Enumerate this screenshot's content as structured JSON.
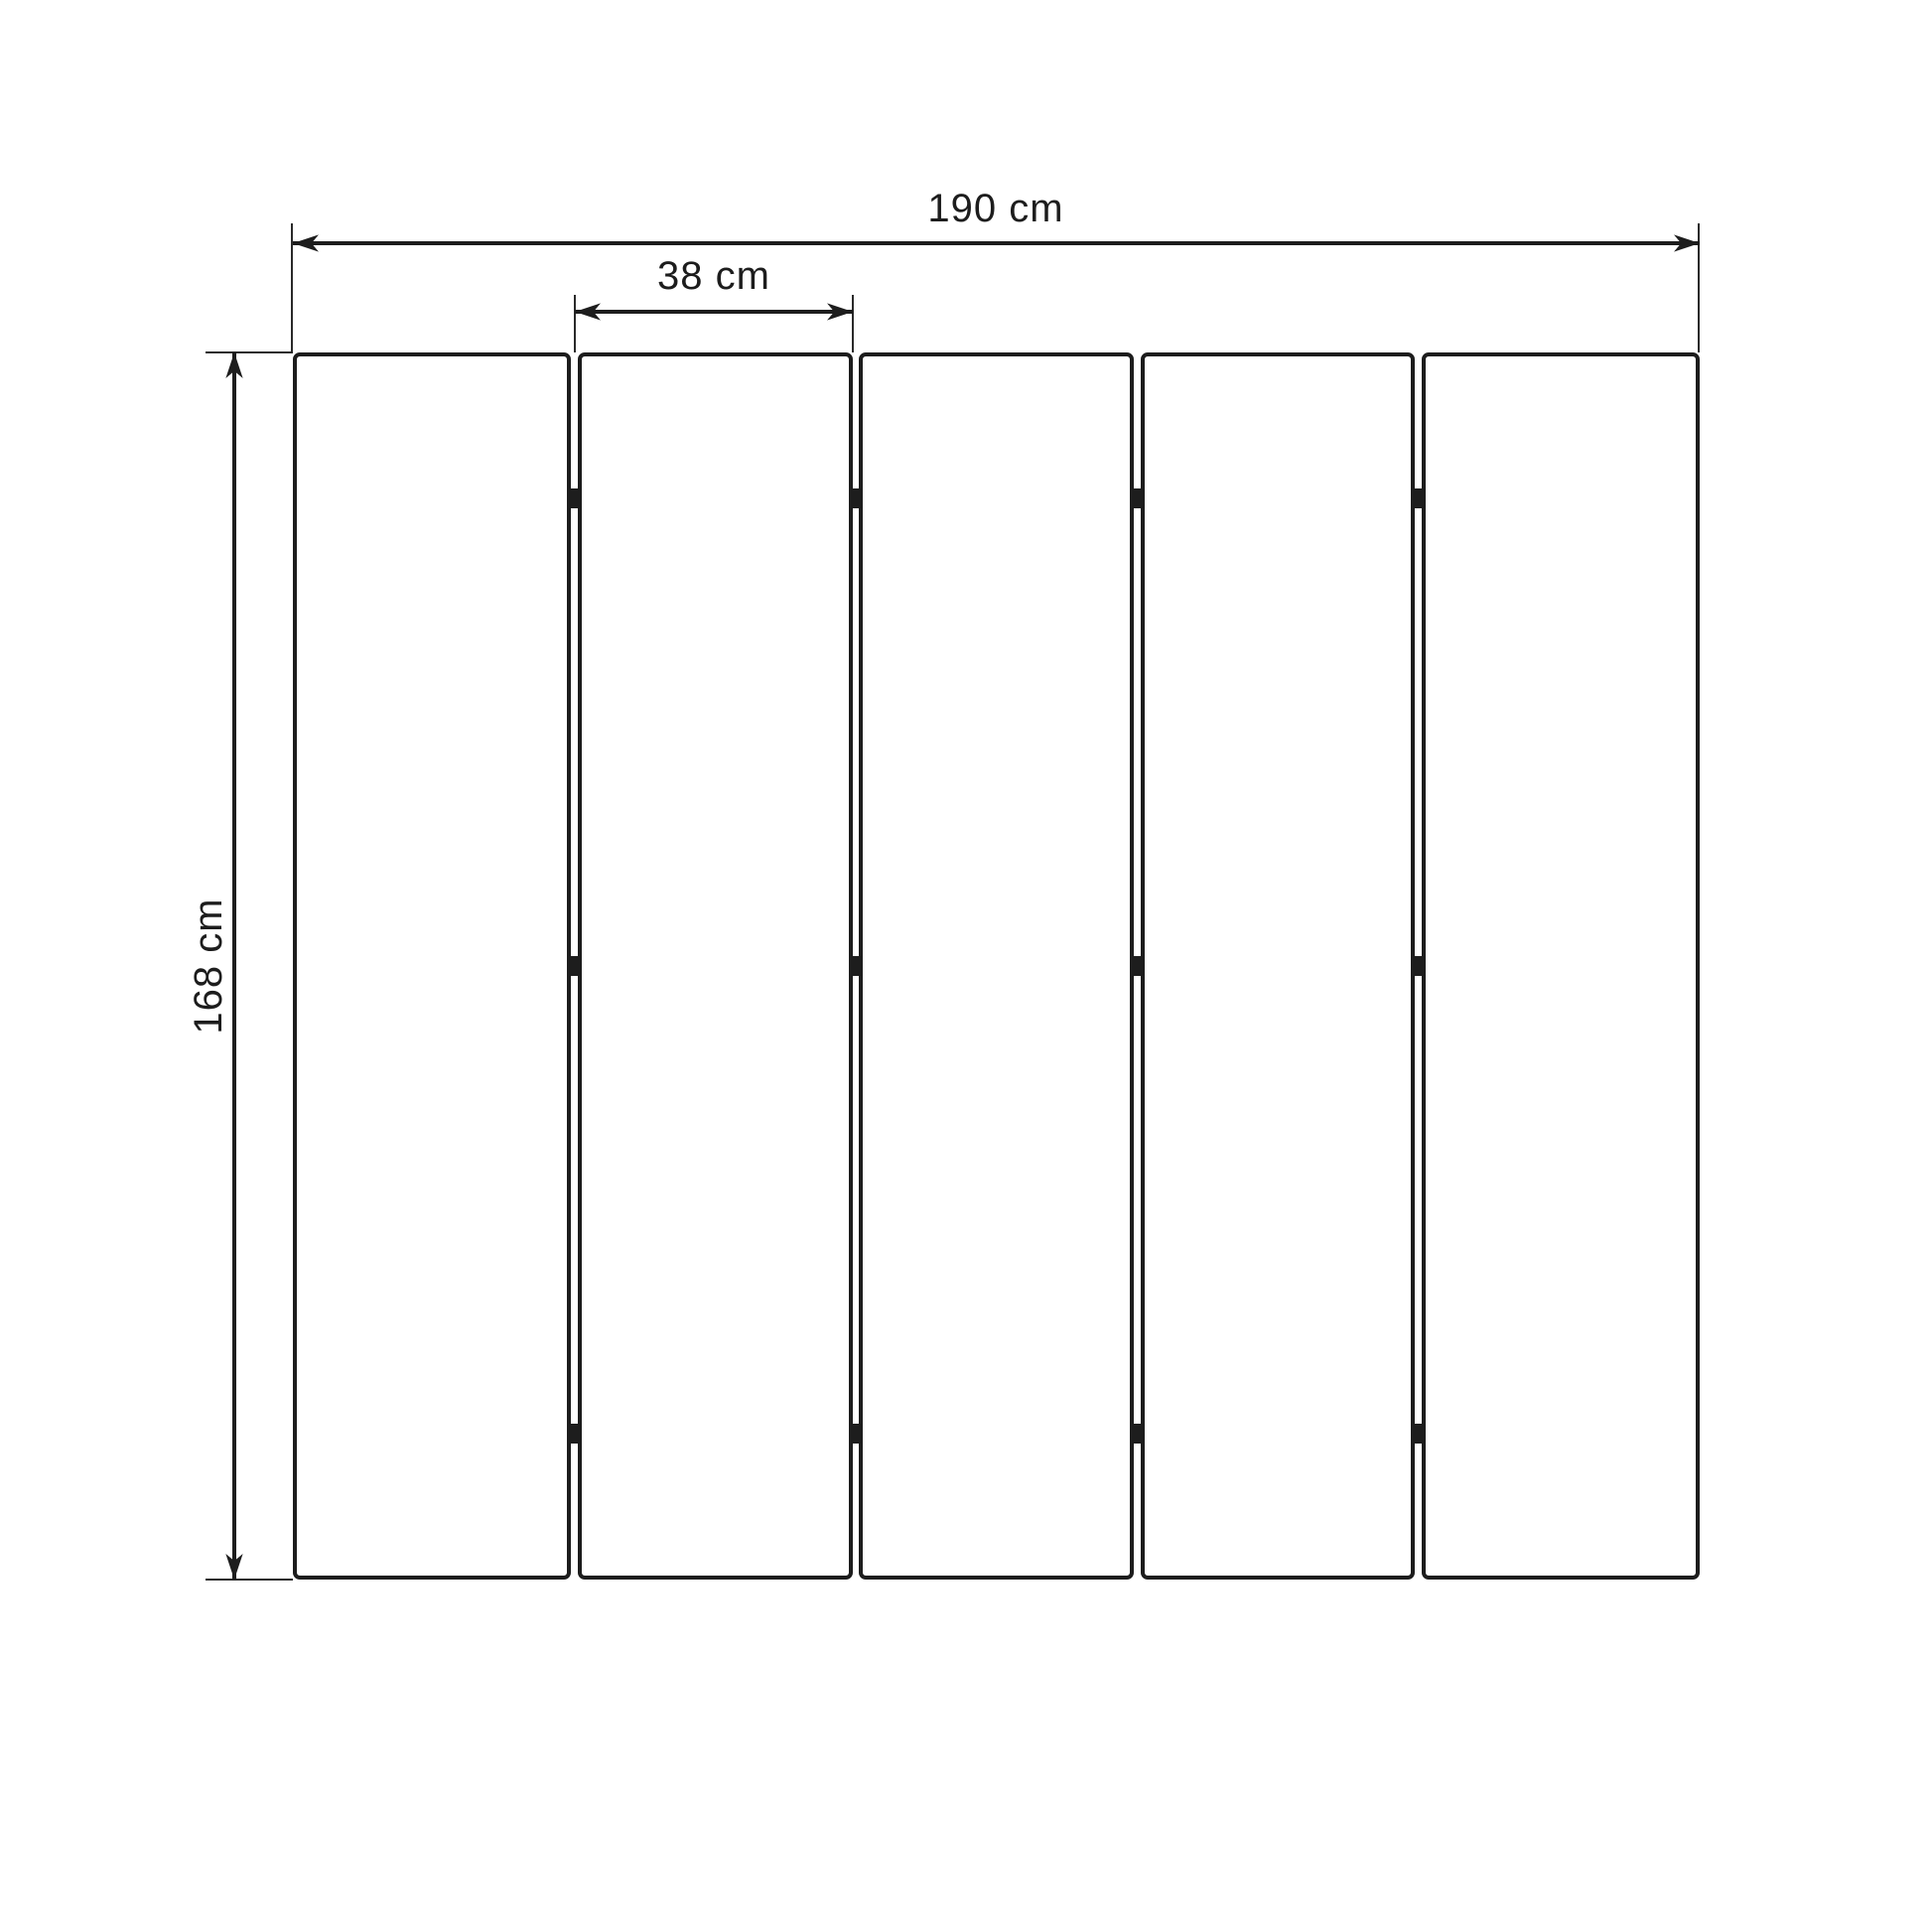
{
  "diagram": {
    "subject": "five-panel folding screen front elevation",
    "panel_count": 5,
    "hinge_rows": 3,
    "dimensions": {
      "total_width": {
        "label": "190 cm",
        "value": 190,
        "unit": "cm"
      },
      "panel_width": {
        "label": "38 cm",
        "value": 38,
        "unit": "cm"
      },
      "height": {
        "label": "168 cm",
        "value": 168,
        "unit": "cm"
      }
    },
    "colors": {
      "line": "#1d1d1d",
      "extension_line": "#2a2a2a",
      "panel_fill": "#ffffff",
      "background": "#ffffff"
    }
  }
}
